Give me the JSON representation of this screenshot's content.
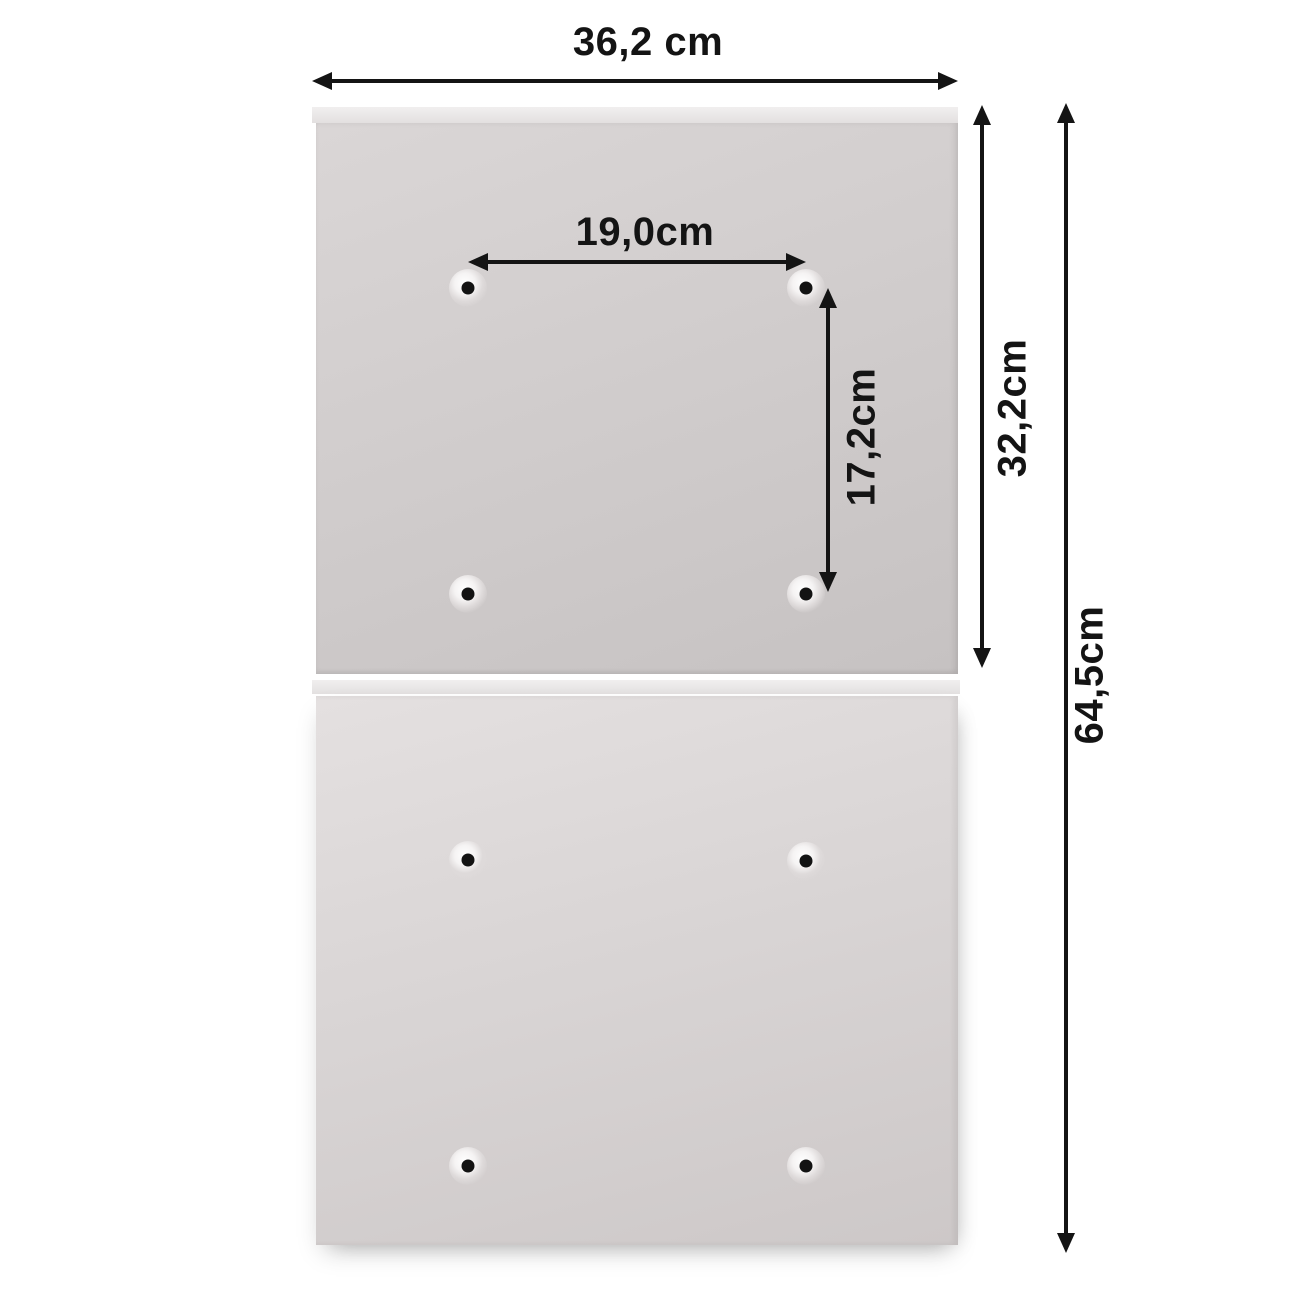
{
  "figure": {
    "type": "product-dimension-diagram",
    "background_color": "#ffffff",
    "panel_color": "#d6d2d2",
    "panel_lip_color": "#ebe9e9",
    "annotation_color": "#141414"
  },
  "annotations": {
    "overall_width": "36,2 cm",
    "hole_spacing_width": "19,0cm",
    "hole_spacing_height": "17,2cm",
    "upper_panel_height": "32,2cm",
    "total_height": "64,5cm"
  },
  "panels": [
    {
      "name": "upper-panel",
      "mounting_holes": 4
    },
    {
      "name": "lower-panel",
      "mounting_holes": 4
    }
  ]
}
